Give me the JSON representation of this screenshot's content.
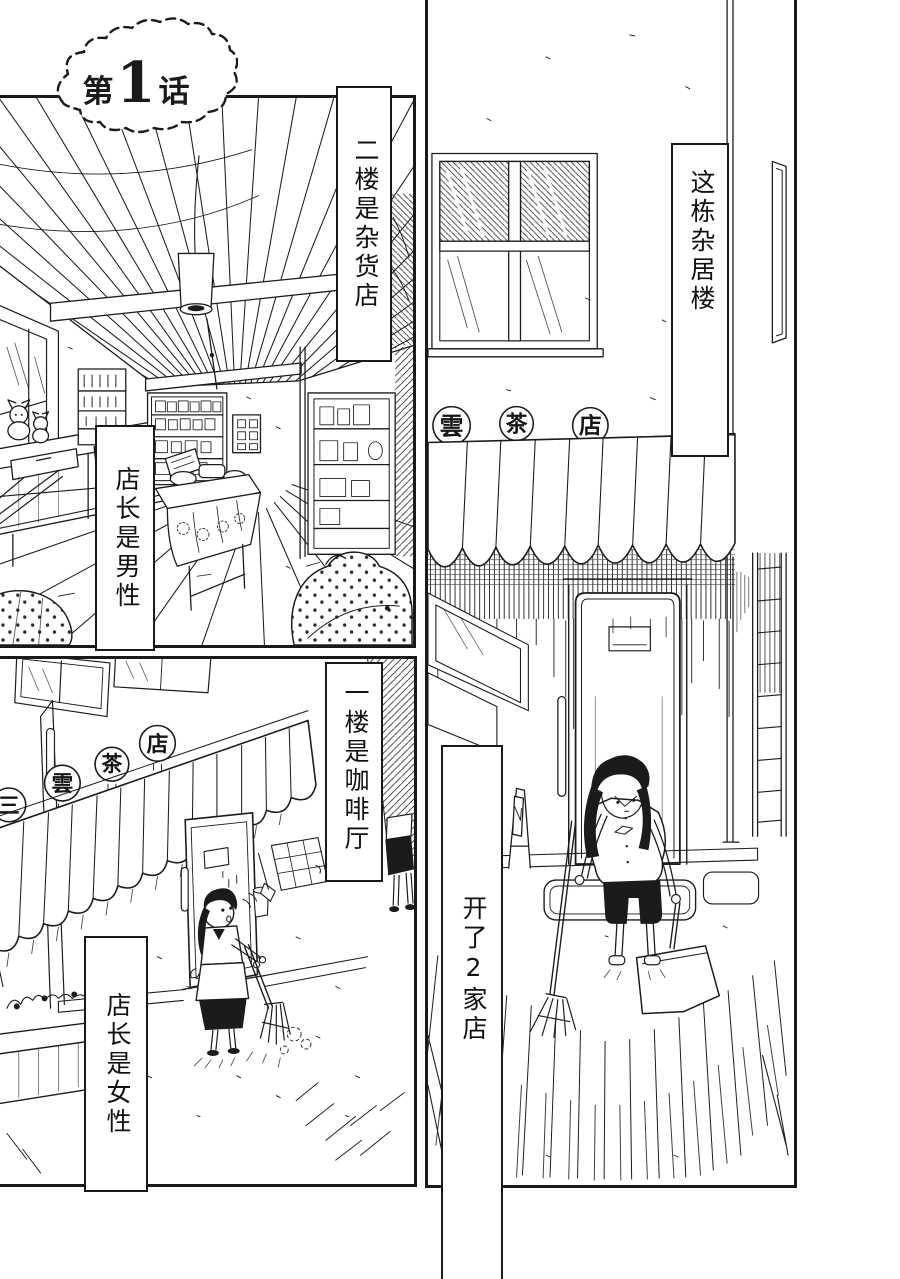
{
  "page_type": "manga page",
  "title": {
    "chapter_prefix": "第",
    "chapter_number": "1",
    "chapter_suffix": "话",
    "chapter_full": "第1话"
  },
  "captions": {
    "floor2_store": "二楼是杂货店",
    "manager_male": "店长是男性",
    "building": "这栋杂居楼",
    "two_shops": "开了2家店",
    "floor1_cafe": "一楼是咖啡厅",
    "manager_female": "店长是女性"
  },
  "signs": {
    "front": [
      "雲",
      "茶",
      "店"
    ],
    "side": [
      "三",
      "雲",
      "茶",
      "店"
    ]
  },
  "colors": {
    "ink": "#1b1b1b",
    "paper": "#ffffff"
  }
}
